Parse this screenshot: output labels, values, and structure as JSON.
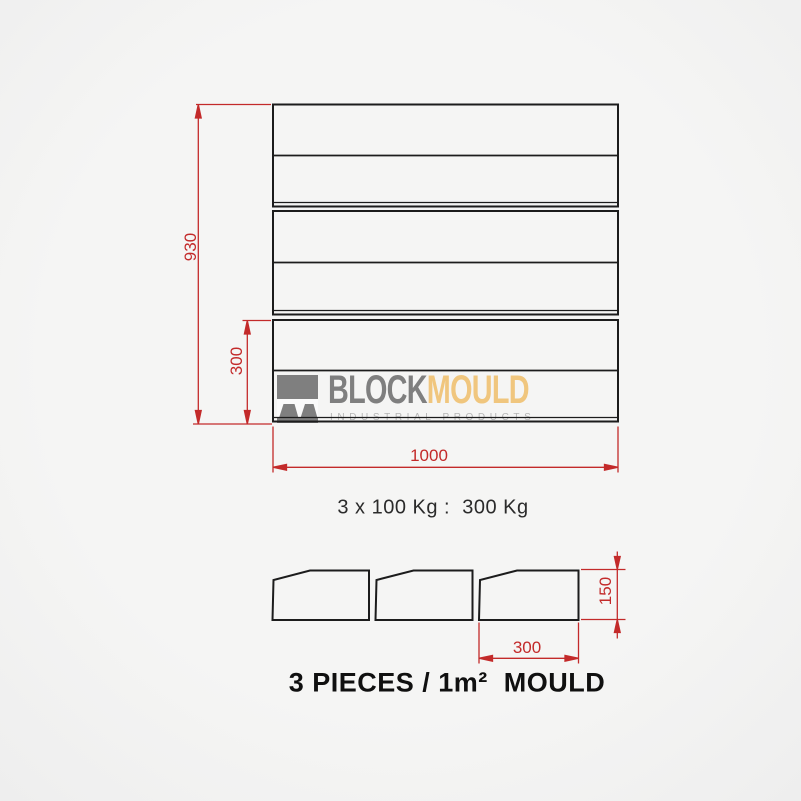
{
  "logo": {
    "word1": "BLOCK",
    "word2": "MOULD",
    "subtitle": "INDUSTRIAL PRODUCTS",
    "word1_color": "#7f7f7f",
    "word2_color": "#f0c67e",
    "subtitle_color": "#b6b6b6"
  },
  "top_view": {
    "height_dim": "930",
    "row_height_dim": "300",
    "width_dim": "1000"
  },
  "pieces_view": {
    "height_dim": "150",
    "width_dim": "300"
  },
  "notes": {
    "weight": "3 x 100 Kg :  300 Kg",
    "caption": "3 PIECES / 1m²  MOULD"
  },
  "colors": {
    "dimension_red": "#c32a2a",
    "outline_black": "#1c1c1c",
    "background": "#f2f2f2"
  }
}
